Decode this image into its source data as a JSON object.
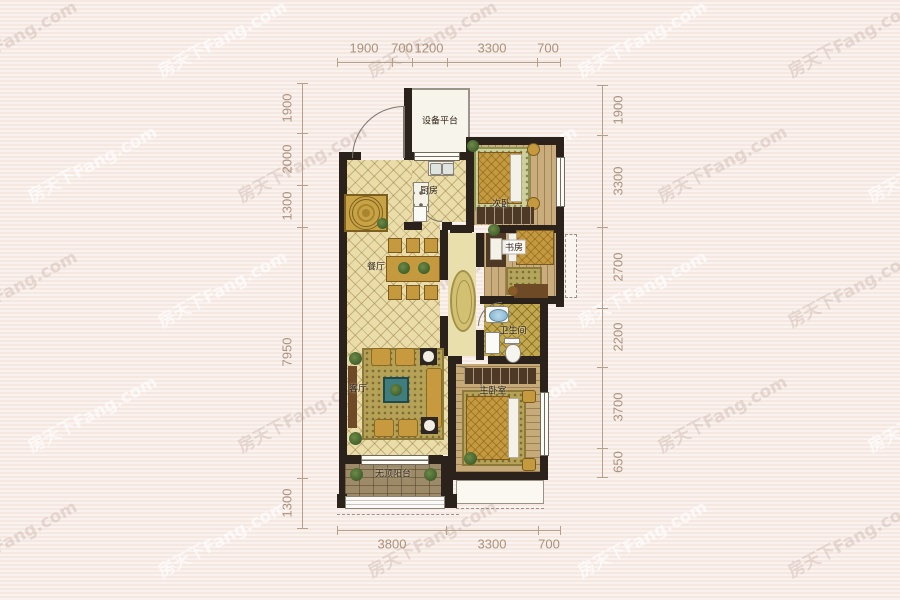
{
  "watermark": {
    "text": "房天下Fang.com"
  },
  "rooms": {
    "equipment_platform": {
      "label": "设备平台"
    },
    "kitchen": {
      "label": "厨房"
    },
    "bedroom2": {
      "label": "次卧"
    },
    "dining": {
      "label": "餐厅"
    },
    "study": {
      "label": "书房"
    },
    "bathroom": {
      "label": "卫生间"
    },
    "living": {
      "label": "客厅"
    },
    "master_bedroom": {
      "label": "主卧室"
    },
    "balcony": {
      "label": "无顶阳台"
    }
  },
  "dims": {
    "top": [
      "1900",
      "700",
      "1200",
      "3300",
      "700"
    ],
    "left": [
      "1900",
      "2000",
      "1300",
      "7950",
      "1300"
    ],
    "right": [
      "1900",
      "3300",
      "2700",
      "2200",
      "3700",
      "650"
    ],
    "bottom": [
      "3800",
      "3300",
      "700"
    ]
  },
  "colors": {
    "background": "#f6ebe5",
    "wall": "#2a221b",
    "floor_cream": "#eaddaa",
    "floor_wood": "#c9ad7c",
    "gold_furniture": "#c59a3f",
    "dimension_text": "#a9927e",
    "watermark": "#b9a094"
  }
}
